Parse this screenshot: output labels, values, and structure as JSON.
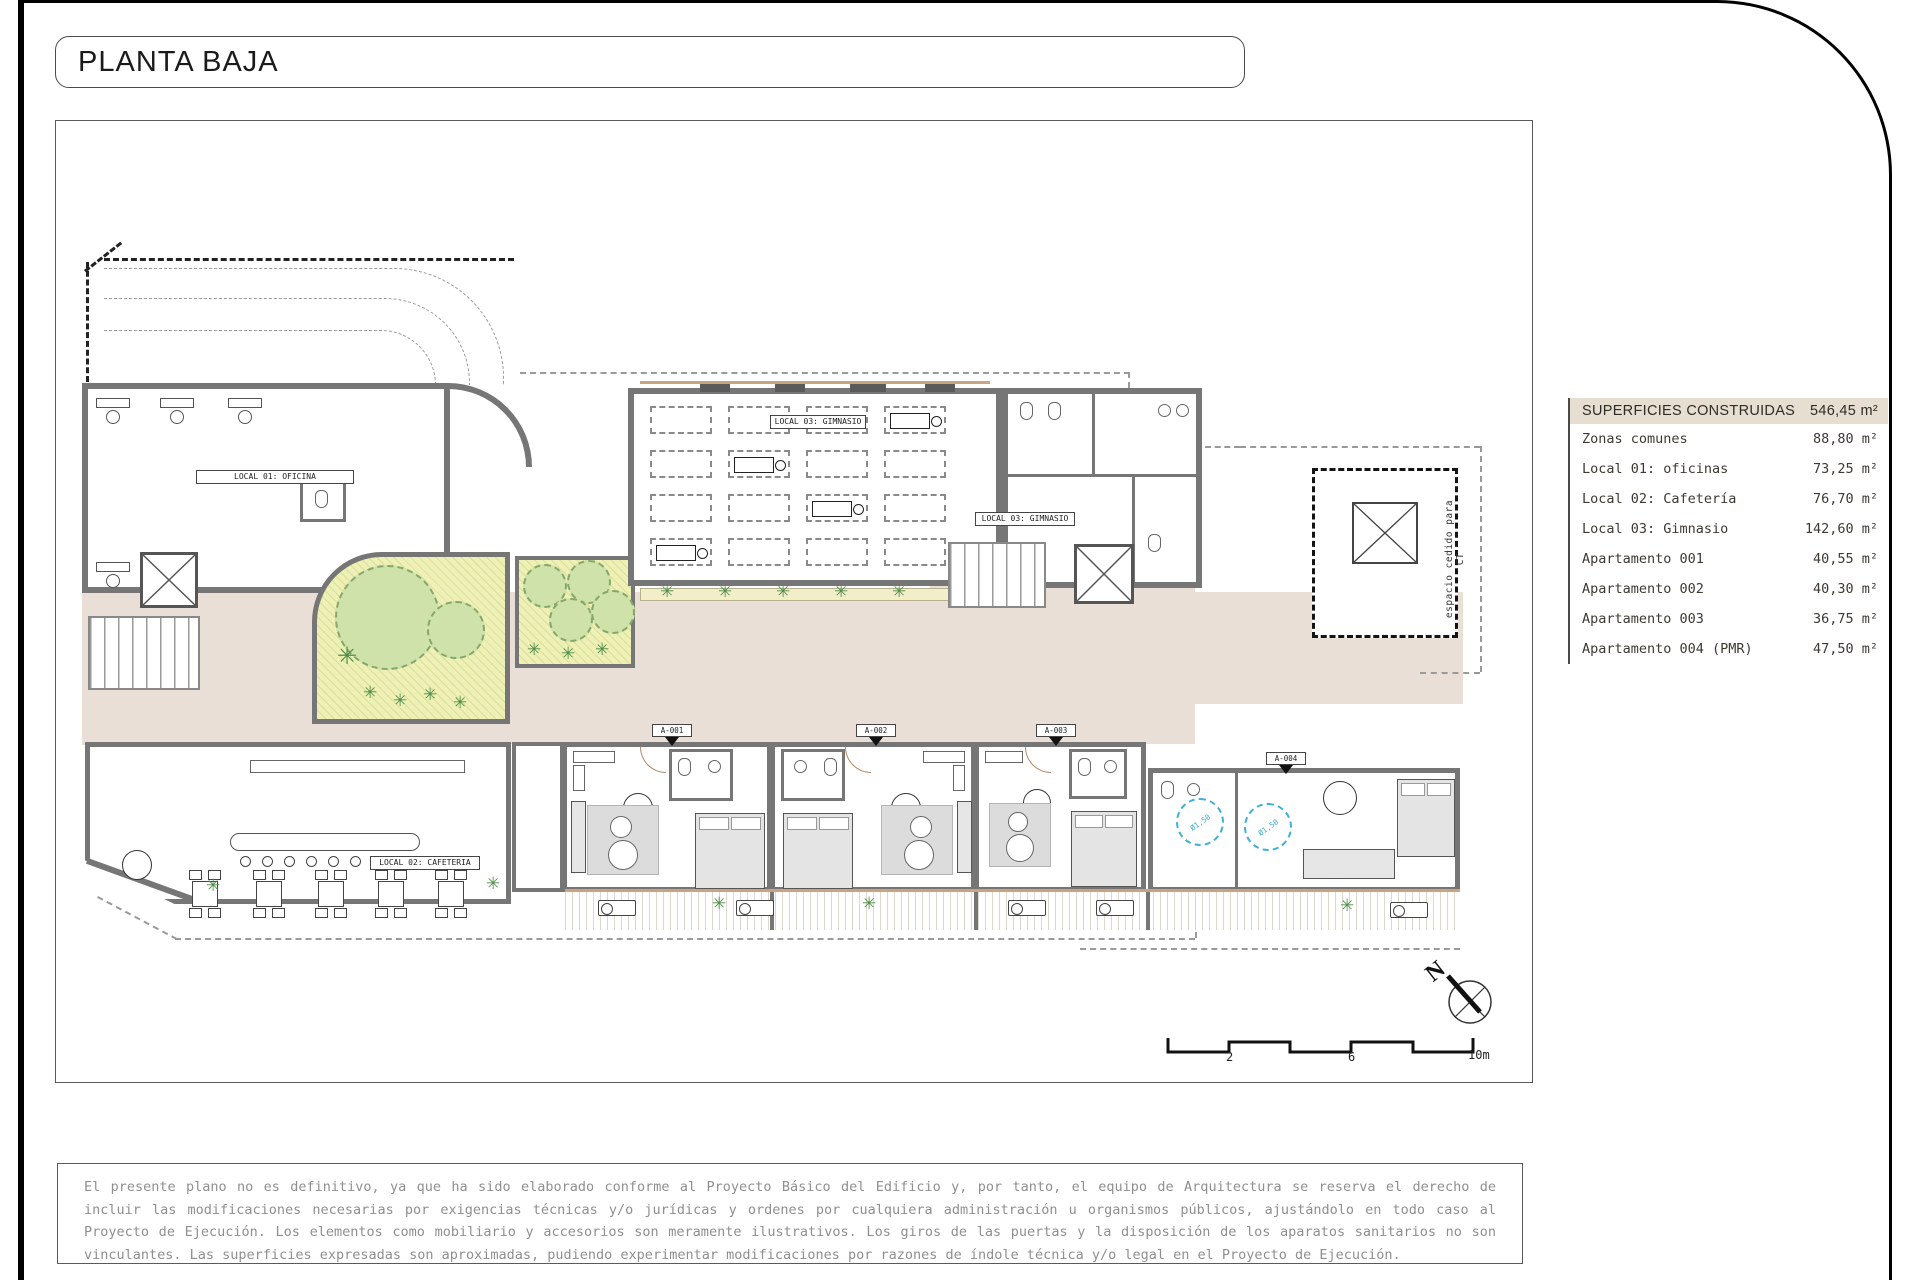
{
  "title": "PLANTA BAJA",
  "legend": {
    "header": {
      "label": "SUPERFICIES CONSTRUIDAS",
      "value": "546,45 m²"
    },
    "rows": [
      {
        "label": "Zonas comunes",
        "value": "88,80 m²"
      },
      {
        "label": "Local 01: oficinas",
        "value": "73,25 m²"
      },
      {
        "label": "Local 02: Cafetería",
        "value": "76,70 m²"
      },
      {
        "label": "Local 03: Gimnasio",
        "value": "142,60 m²"
      },
      {
        "label": "Apartamento 001",
        "value": "40,55 m²"
      },
      {
        "label": "Apartamento 002",
        "value": "40,30 m²"
      },
      {
        "label": "Apartamento 003",
        "value": "36,75 m²"
      },
      {
        "label": "Apartamento 004 (PMR)",
        "value": "47,50 m²"
      }
    ]
  },
  "plan": {
    "labels": {
      "local01": "LOCAL 01: OFICINA",
      "local02": "LOCAL 02: CAFETERIA",
      "local03": "LOCAL 03: GIMNASIO",
      "apt1": "A-001",
      "apt2": "A-002",
      "apt3": "A-003",
      "apt4": "A-004",
      "ict": "espacio cedido para CT",
      "pmr_radius": "Ø1,50"
    },
    "north": "N",
    "scale": {
      "t2": "2",
      "t6": "6",
      "t10": "10m"
    }
  },
  "colors": {
    "wall": "#767676",
    "common_floor": "#e9dfd6",
    "garden": "#eef0b6",
    "accessible_blue": "#41b0d9",
    "legend_header_bg": "#e6ded1"
  },
  "disclaimer": "El presente plano no es definitivo, ya que ha sido elaborado conforme al Proyecto Básico del Edificio y, por tanto, el equipo de Arquitectura se reserva el derecho de incluir las modificaciones necesarias por exigencias técnicas y/o jurídicas y ordenes por cualquiera administración u organismos públicos, ajustándolo en todo caso al Proyecto de Ejecución. Los elementos como mobiliario y accesorios son meramente ilustrativos. Los giros de las puertas y la disposición de los aparatos sanitarios no son vinculantes. Las superficies expresadas son aproximadas, pudiendo experimentar modificaciones por razones de índole técnica y/o legal en el Proyecto de Ejecución."
}
